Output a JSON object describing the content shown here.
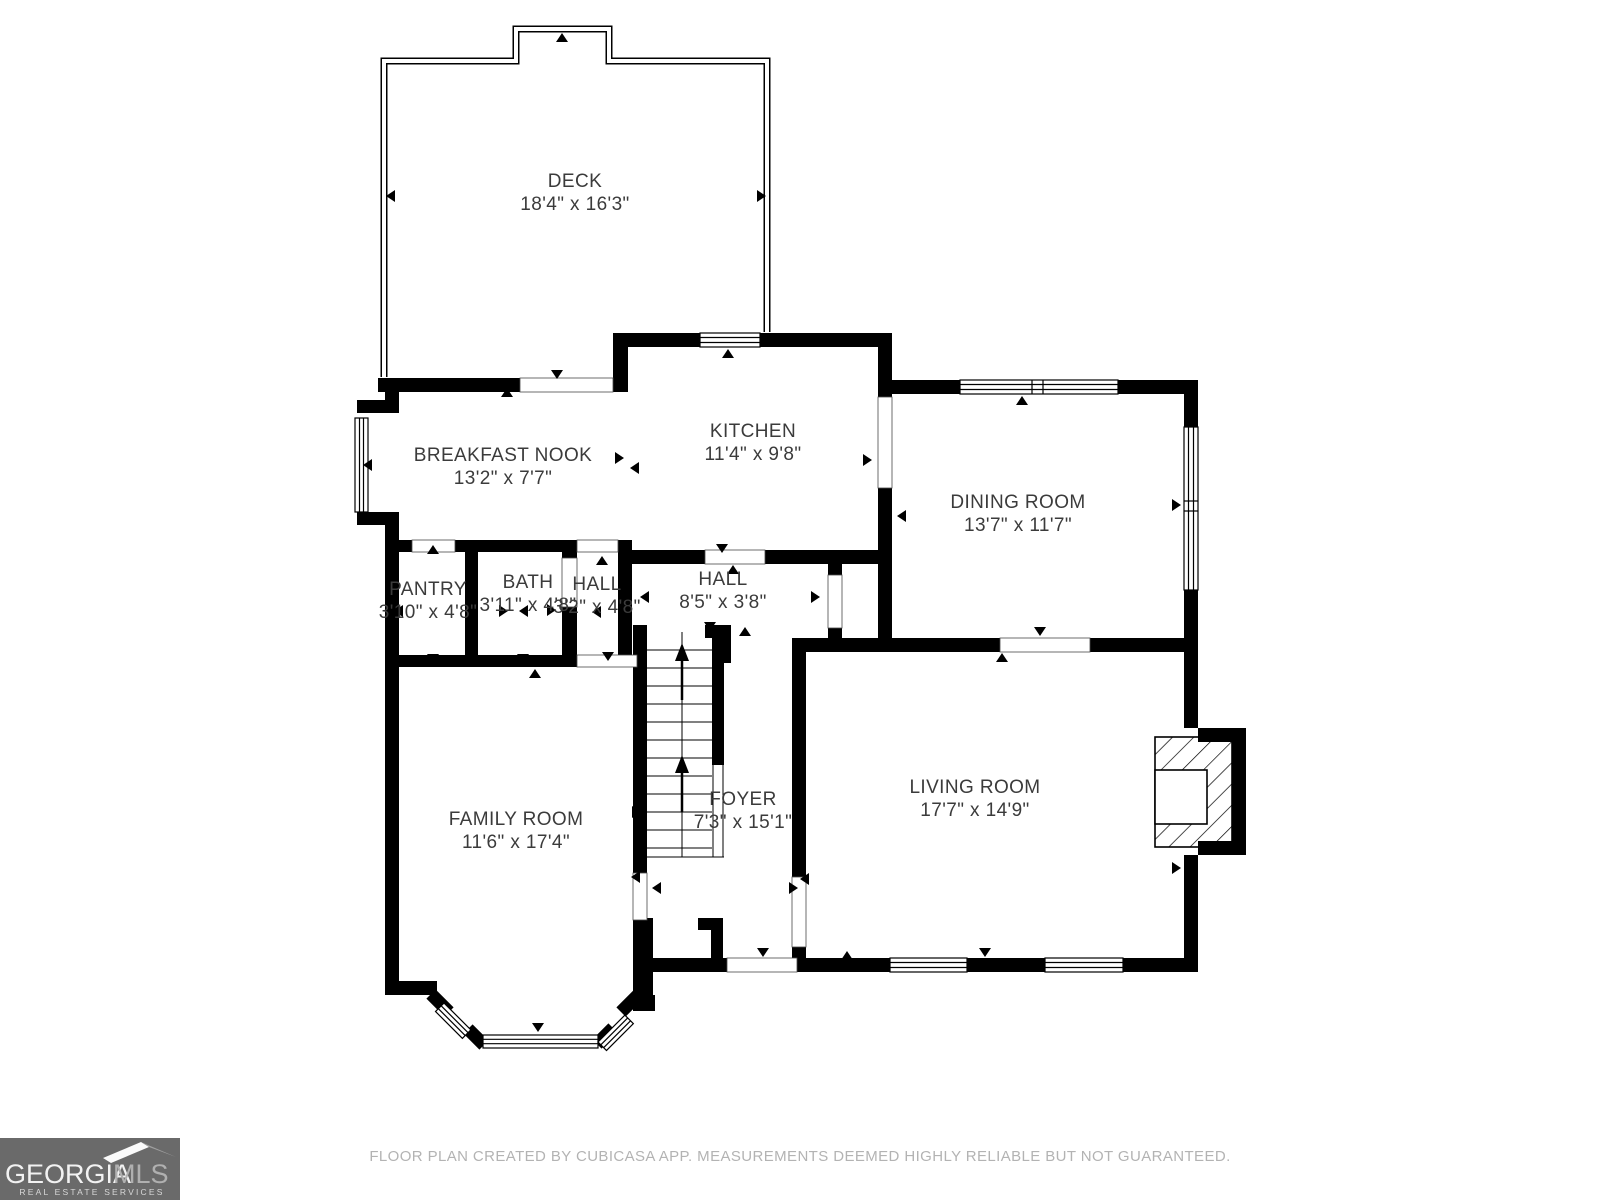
{
  "colors": {
    "wall": "#000000",
    "label_text": "#3b3b3b",
    "footer_text": "#b3b3b3",
    "logo_background": "#6a6a6a"
  },
  "rooms": {
    "deck": {
      "name": "DECK",
      "dims": "18'4\" x 16'3\""
    },
    "breakfast_nook": {
      "name": "BREAKFAST NOOK",
      "dims": "13'2\" x 7'7\""
    },
    "kitchen": {
      "name": "KITCHEN",
      "dims": "11'4\" x 9'8\""
    },
    "dining_room": {
      "name": "DINING ROOM",
      "dims": "13'7\" x 11'7\""
    },
    "pantry": {
      "name": "PANTRY",
      "dims": "3'10\" x 4'8\""
    },
    "bath": {
      "name": "BATH",
      "dims": "3'11\" x 4'8\""
    },
    "hall_small": {
      "name": "HALL",
      "dims": "3'2\" x 4'8\""
    },
    "hall": {
      "name": "HALL",
      "dims": "8'5\" x 3'8\""
    },
    "foyer": {
      "name": "FOYER",
      "dims": "7'3\" x 15'1\""
    },
    "family_room": {
      "name": "FAMILY ROOM",
      "dims": "11'6\" x 17'4\""
    },
    "living_room": {
      "name": "LIVING ROOM",
      "dims": "17'7\" x 14'9\""
    }
  },
  "footer": {
    "disclaimer": "FLOOR PLAN CREATED BY CUBICASA APP. MEASUREMENTS DEEMED HIGHLY RELIABLE BUT NOT GUARANTEED."
  },
  "logo": {
    "brand_primary": "GEORGIA",
    "brand_secondary": "MLS",
    "tagline": "REAL ESTATE SERVICES"
  }
}
